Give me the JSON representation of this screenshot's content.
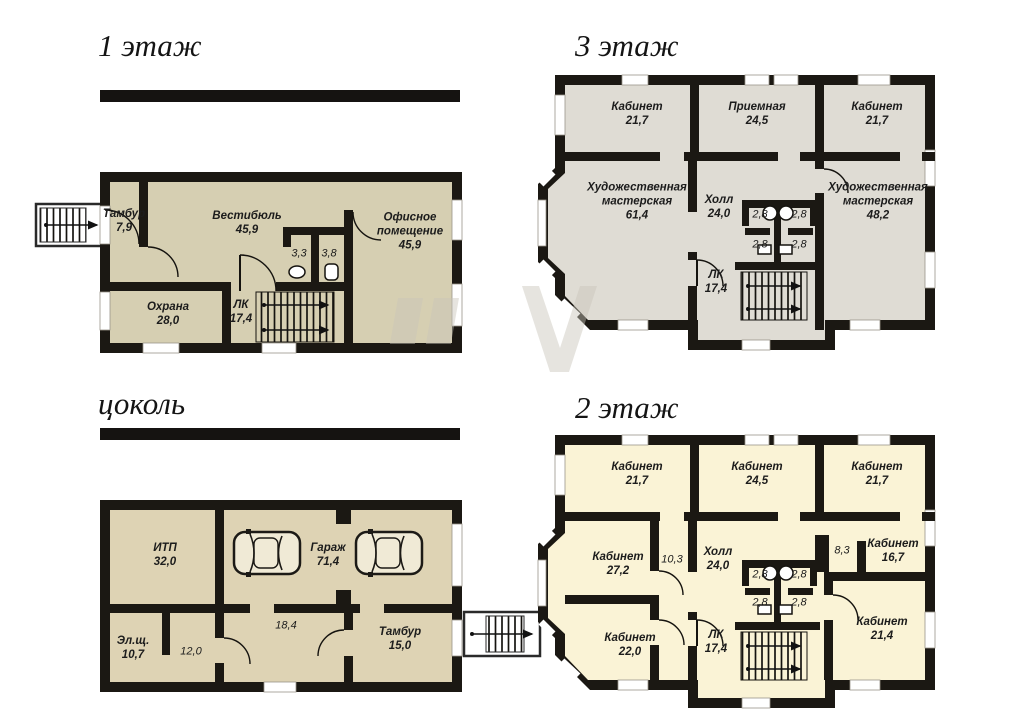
{
  "page": {
    "background": "#ffffff"
  },
  "colors": {
    "wall": "#1b1813",
    "window": "#ffffff",
    "floor1_fill": "#d6cfb2",
    "floor3_fill": "#dfdcd4",
    "basement_fill": "#ded3b4",
    "floor2_fill": "#faf3d6"
  },
  "floors": {
    "f1": {
      "title": "1 этаж",
      "rooms": [
        {
          "name": "Тамбур",
          "area": "7,9"
        },
        {
          "name": "Вестибюль",
          "area": "45,9"
        },
        {
          "name": "",
          "area": "3,3"
        },
        {
          "name": "",
          "area": "3,8"
        },
        {
          "name": "Офисное помещение",
          "area": "45,9"
        },
        {
          "name": "Охрана",
          "area": "28,0"
        },
        {
          "name": "ЛК",
          "area": "17,4"
        }
      ]
    },
    "f3": {
      "title": "3 этаж",
      "rooms": [
        {
          "name": "Кабинет",
          "area": "21,7"
        },
        {
          "name": "Приемная",
          "area": "24,5"
        },
        {
          "name": "Кабинет",
          "area": "21,7"
        },
        {
          "name": "Художественная мастерская",
          "area": "61,4"
        },
        {
          "name": "Холл",
          "area": "24,0"
        },
        {
          "name": "",
          "area": "2,8"
        },
        {
          "name": "",
          "area": "2,8"
        },
        {
          "name": "",
          "area": "2,8"
        },
        {
          "name": "",
          "area": "2,8"
        },
        {
          "name": "Художественная мастерская",
          "area": "48,2"
        },
        {
          "name": "ЛК",
          "area": "17,4"
        }
      ]
    },
    "f0": {
      "title": "цоколь",
      "rooms": [
        {
          "name": "ИТП",
          "area": "32,0"
        },
        {
          "name": "Гараж",
          "area": "71,4"
        },
        {
          "name": "Эл.щ.",
          "area": "10,7"
        },
        {
          "name": "",
          "area": "12,0"
        },
        {
          "name": "",
          "area": "18,4"
        },
        {
          "name": "Тамбур",
          "area": "15,0"
        }
      ]
    },
    "f2": {
      "title": "2 этаж",
      "rooms": [
        {
          "name": "Кабинет",
          "area": "21,7"
        },
        {
          "name": "Кабинет",
          "area": "24,5"
        },
        {
          "name": "Кабинет",
          "area": "21,7"
        },
        {
          "name": "Кабинет",
          "area": "27,2"
        },
        {
          "name": "",
          "area": "10,3"
        },
        {
          "name": "Холл",
          "area": "24,0"
        },
        {
          "name": "",
          "area": "2,8"
        },
        {
          "name": "",
          "area": "2,8"
        },
        {
          "name": "",
          "area": "2,8"
        },
        {
          "name": "",
          "area": "2,8"
        },
        {
          "name": "",
          "area": "8,3"
        },
        {
          "name": "Кабинет",
          "area": "16,7"
        },
        {
          "name": "Кабинет",
          "area": "22,0"
        },
        {
          "name": "ЛК",
          "area": "17,4"
        },
        {
          "name": "Кабинет",
          "area": "21,4"
        }
      ]
    }
  }
}
